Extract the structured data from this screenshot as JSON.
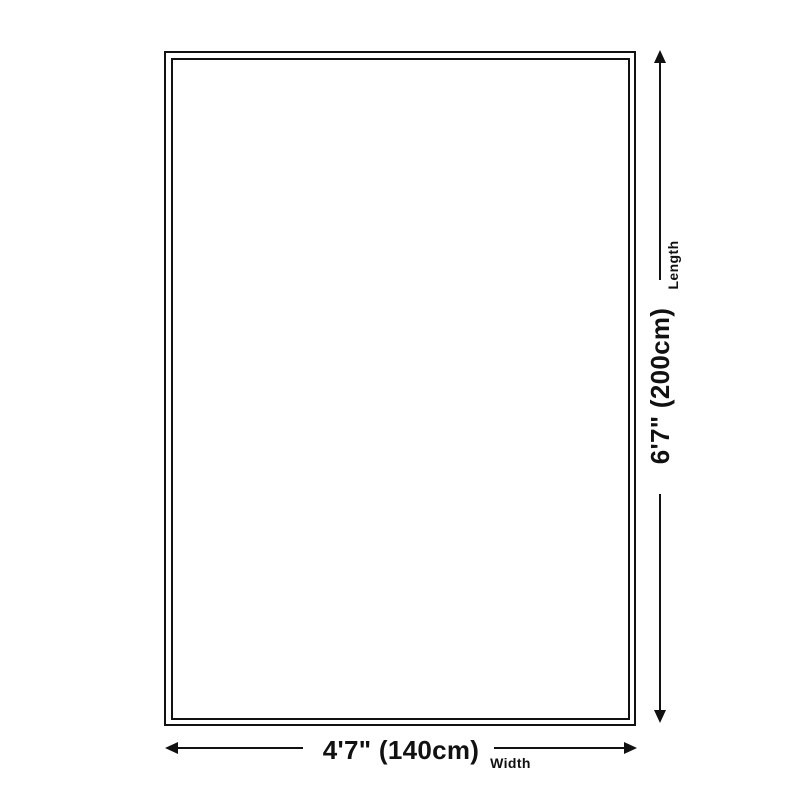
{
  "diagram": {
    "type": "product-size-diagram",
    "colors": {
      "background": "#ffffff",
      "line": "#111111",
      "text": "#111111"
    },
    "item_outline": {
      "shape": "rectangle",
      "style": "double-border"
    },
    "length": {
      "value": "6'7\" (200cm)",
      "label": "Length"
    },
    "width": {
      "value": "4'7\" (140cm)",
      "label": "Width"
    },
    "icons": [
      "arrow-up-icon",
      "arrow-down-icon",
      "arrow-left-icon",
      "arrow-right-icon"
    ]
  }
}
